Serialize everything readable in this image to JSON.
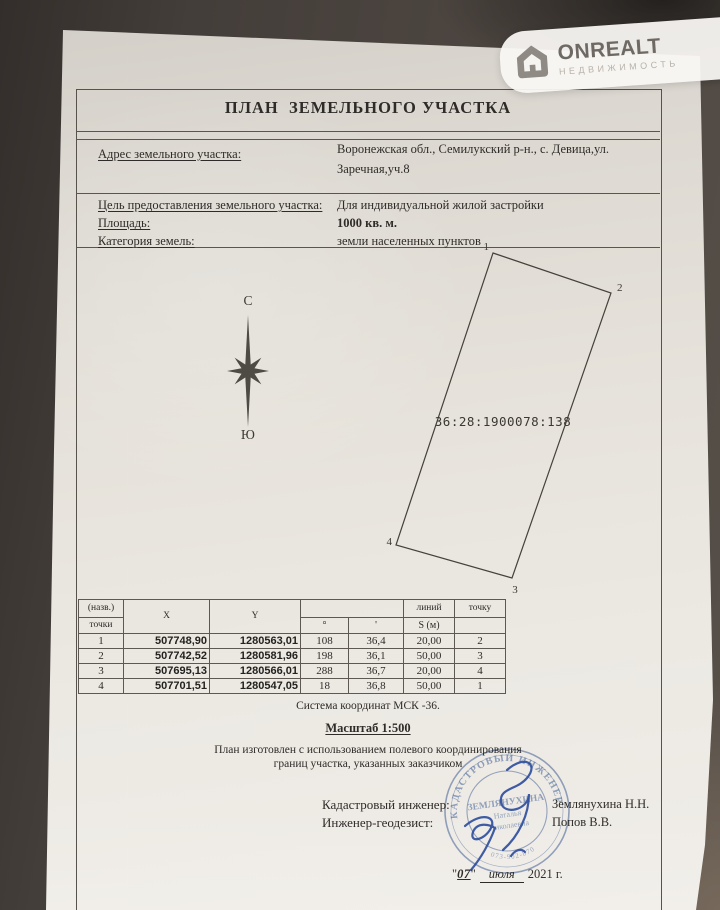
{
  "watermark": {
    "brand": "ONREALT",
    "subtitle": "НЕДВИЖИМОСТЬ",
    "icon": "house-icon"
  },
  "doc": {
    "title": "ПЛАН  ЗЕМЕЛЬНОГО УЧАСТКА",
    "fields": {
      "address_label": "Адрес земельного участка:",
      "address_value1": "Воронежская обл., Семилукский р-н., с. Девица,ул.",
      "address_value2": "Заречная,уч.8",
      "purpose_label": "Цель предоставления земельного участка:",
      "purpose_value": "Для индивидуальной жилой застройки",
      "area_label": "Площадь:",
      "area_value": "1000 кв. м.",
      "category_label": "Категория земель:",
      "category_value": "земли населенных пунктов"
    },
    "compass": {
      "north": "С",
      "south": "Ю"
    },
    "plot": {
      "cadastral_number": "36:28:1900078:138",
      "corners": [
        "1",
        "2",
        "3",
        "4"
      ]
    },
    "table": {
      "header": {
        "name_top": "(назв.)",
        "name_bottom": "точки",
        "x": "X",
        "y": "Y",
        "deg": "°",
        "min": "'",
        "lines_top": "линий",
        "lines_bottom": "S (м)",
        "to_point": "точку"
      },
      "rows": [
        [
          "1",
          "507748,90",
          "1280563,01",
          "108",
          "36,4",
          "20,00",
          "2"
        ],
        [
          "2",
          "507742,52",
          "1280581,96",
          "198",
          "36,1",
          "50,00",
          "3"
        ],
        [
          "3",
          "507695,13",
          "1280566,01",
          "288",
          "36,7",
          "20,00",
          "4"
        ],
        [
          "4",
          "507701,51",
          "1280547,05",
          "18",
          "36,8",
          "50,00",
          "1"
        ]
      ]
    },
    "coord_system": "Система координат МСК -36.",
    "scale": "Масштаб 1:500",
    "note1": "План изготовлен с использованием полевого координирования",
    "note2": "границ участка, указанных заказчиком",
    "sign": {
      "role1": "Кадастровый инженер:",
      "name1": "Землянухина Н.Н.",
      "role2": "Инженер-геодезист:",
      "name2": "Попов В.В."
    },
    "stamp": {
      "ring": "КАДАСТРОВЫЙ ИНЖЕНЕР",
      "bottom": "073-902-870",
      "line1": "ЗЕМЛЯНУХИНА",
      "line2": "Наталья",
      "line3": "Николаевна"
    },
    "date": {
      "q1": "\"",
      "day": "07",
      "q2": "\"",
      "month": "июля",
      "tail": "2021 г."
    }
  }
}
